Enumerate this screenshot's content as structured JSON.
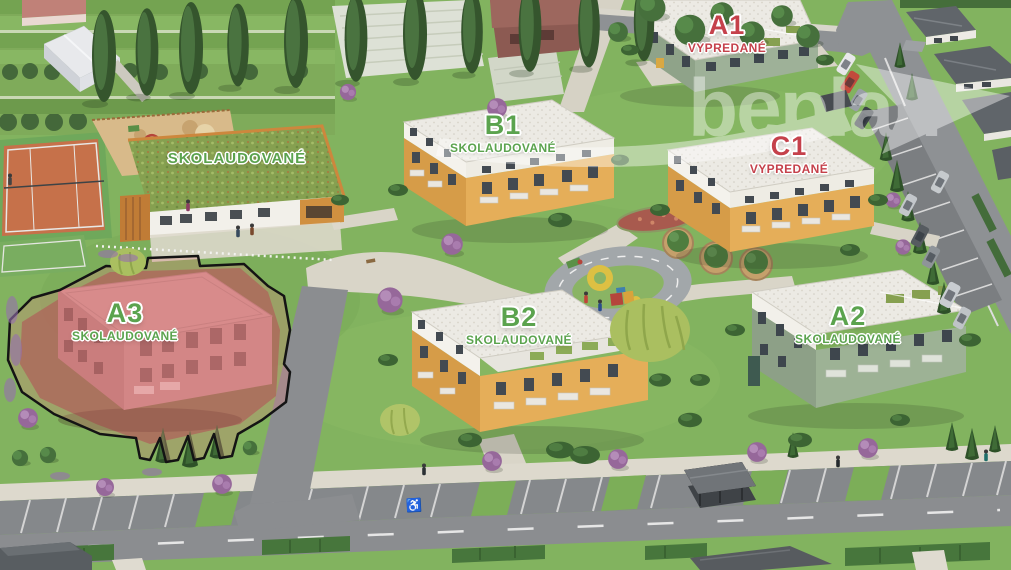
{
  "site_plan": {
    "watermark": {
      "text": "beplan",
      "arrow_icon": "watermark-arrow-icon"
    },
    "status_colors": {
      "approved": "#5ba34e",
      "sold": "#c5414b",
      "label_outline": "#ffffff"
    },
    "kindergarten": {
      "status": "SKOLAUDOVANÉ",
      "status_type": "approved"
    },
    "buildings": [
      {
        "code": "A1",
        "status": "VYPREDANÉ",
        "status_type": "sold"
      },
      {
        "code": "B1",
        "status": "SKOLAUDOVANÉ",
        "status_type": "approved"
      },
      {
        "code": "C1",
        "status": "VYPREDANÉ",
        "status_type": "sold"
      },
      {
        "code": "A3",
        "status": "SKOLAUDOVANÉ",
        "status_type": "approved",
        "highlighted": true
      },
      {
        "code": "B2",
        "status": "SKOLAUDOVANÉ",
        "status_type": "approved"
      },
      {
        "code": "A2",
        "status": "SKOLAUDOVANÉ",
        "status_type": "approved"
      }
    ],
    "icons": {
      "handicap_parking": "♿"
    }
  }
}
